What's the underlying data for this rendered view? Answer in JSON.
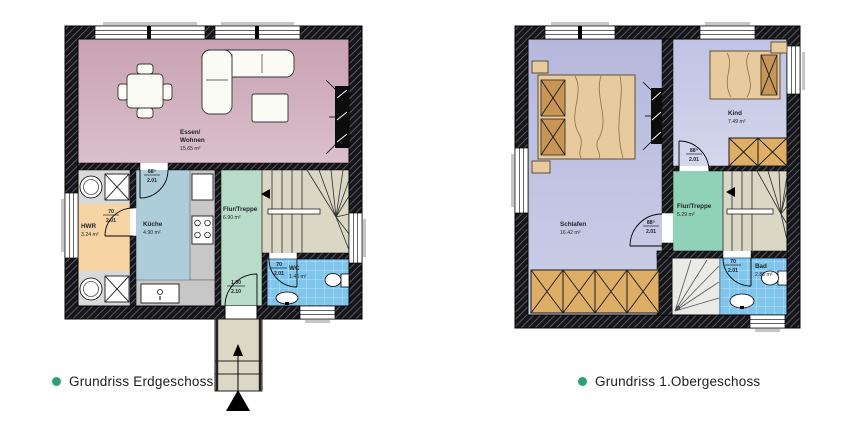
{
  "legend": {
    "eg": "Grundriss Erdgeschoss",
    "og": "Grundriss 1.Obergeschoss"
  },
  "colors": {
    "bullet": "#2aa07d",
    "wohnen": "#c9a2b2",
    "kueche": "#aecdda",
    "hwr": "#f7d4a3",
    "flur_eg": "#b8dcc8",
    "wc_tile": "#7fc5ec",
    "schlafen": "#b5b8dc",
    "kind": "#c0c3e3",
    "flur_og": "#8fd2b9",
    "stairs": "#dbd7c5",
    "wardrobe": "#dfae66",
    "porch": "#dcd8c6"
  },
  "eg": {
    "rooms": {
      "wohnen": {
        "line1": "Essen/",
        "line2": "Wohnen",
        "area": "15.65 m²"
      },
      "kueche": {
        "name": "Küche",
        "area": "4.90 m²"
      },
      "hwr": {
        "name": "HWR",
        "area": "3.24 m²"
      },
      "flur": {
        "name": "Flur/Treppe",
        "area": "6.90 m²"
      },
      "wc": {
        "name": "WC",
        "area": "1.46 m²"
      }
    },
    "doors": {
      "kueche": {
        "w": "88⁵",
        "h": "2.01"
      },
      "hwr": {
        "w": "70",
        "h": "2.01"
      },
      "wc": {
        "w": "70",
        "h": "2.01"
      },
      "entry": {
        "w": "1.00",
        "h": "2.10"
      }
    }
  },
  "og": {
    "rooms": {
      "schlafen": {
        "name": "Schlafen",
        "area": "16.42 m²"
      },
      "kind": {
        "name": "Kind",
        "area": "7.49 m²"
      },
      "flur": {
        "name": "Flur/Treppe",
        "area": "5.29 m²"
      },
      "bad": {
        "name": "Bad",
        "area": "2.86 m²"
      }
    },
    "doors": {
      "schlafen": {
        "w": "88⁵",
        "h": "2.01"
      },
      "kind": {
        "w": "88⁵",
        "h": "2.01"
      },
      "bad": {
        "w": "70",
        "h": "2.01"
      }
    }
  }
}
